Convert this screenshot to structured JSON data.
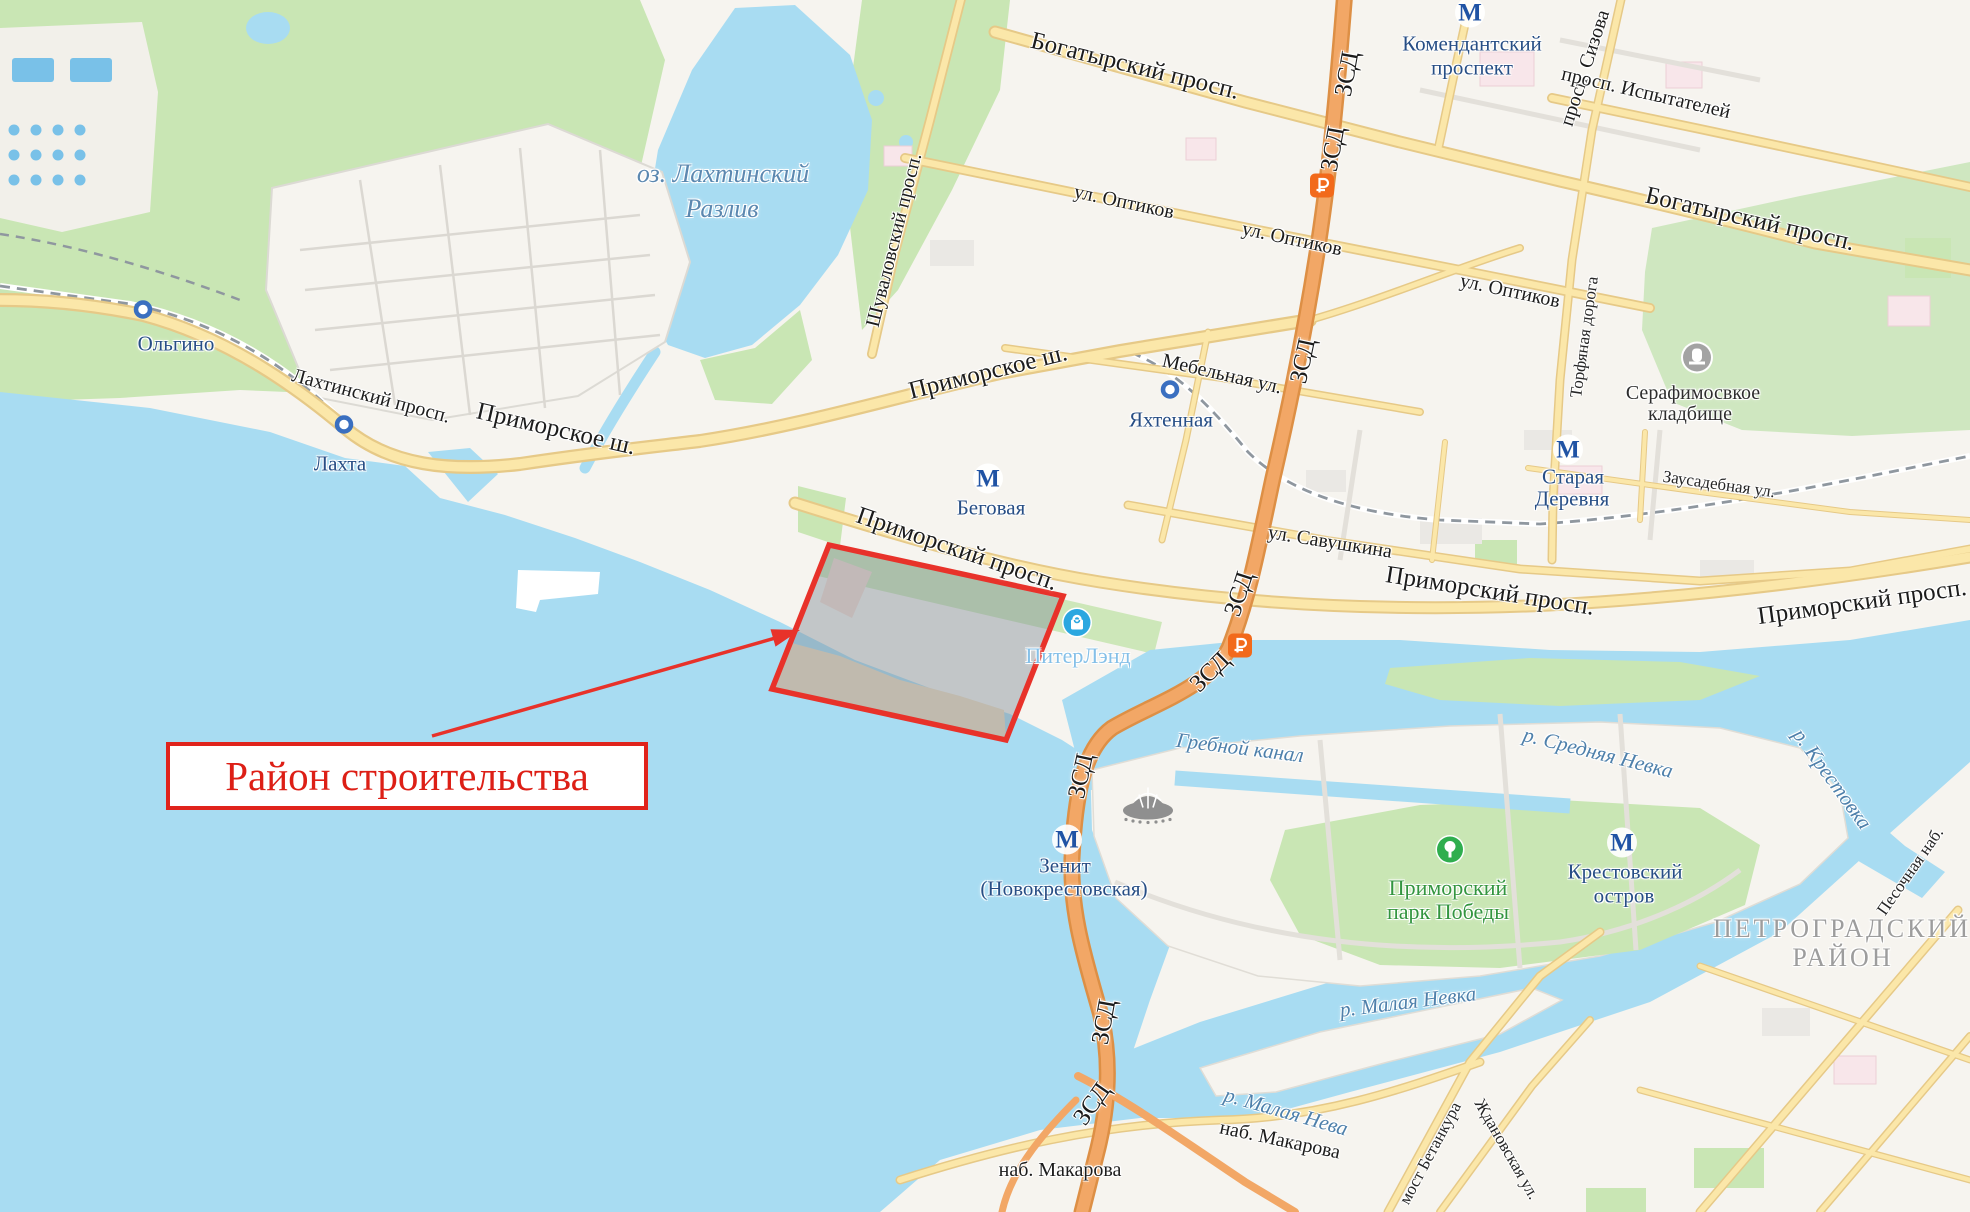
{
  "map": {
    "annotation": {
      "label": "Район строительства"
    },
    "colors": {
      "water": "#a8dcf2",
      "land": "#f6f4ef",
      "park": "#c9e6b4",
      "road_fill": "#fbe7a9",
      "road_casing": "#e6c987",
      "highway_fill": "#f2a766",
      "highway_casing": "#dd8f45",
      "railway": "#8f979f",
      "accent_red": "#e0231c",
      "metro_blue": "#2053a4",
      "station_text": "#274e85",
      "water_text": "#4e80ab",
      "district_gray": "#9d9d9d",
      "park_green": "#33953f",
      "mall_blue": "#2ba7e0",
      "toll_orange": "#f26a1b"
    },
    "labels": [
      {
        "id": "bogatyrsky-prosp-1",
        "text": "Богатырский просп.",
        "x": 1135,
        "y": 66,
        "rot": 14,
        "cls": "road-lg"
      },
      {
        "id": "bogatyrsky-prosp-2",
        "text": "Богатырский просп.",
        "x": 1750,
        "y": 219,
        "rot": 13,
        "cls": "road-lg"
      },
      {
        "id": "komendantsky-line1",
        "text": "Комендантский",
        "x": 1472,
        "y": 44,
        "rot": 0,
        "cls": "metro"
      },
      {
        "id": "komendantsky-line2",
        "text": "проспект",
        "x": 1472,
        "y": 68,
        "rot": 0,
        "cls": "metro"
      },
      {
        "id": "prosp-sizova",
        "text": "просп. Сизова",
        "x": 1585,
        "y": 68,
        "rot": -72,
        "cls": "road"
      },
      {
        "id": "prosp-ispytateley",
        "text": "просп. Испытателей",
        "x": 1646,
        "y": 93,
        "rot": 13,
        "cls": "road"
      },
      {
        "id": "zsd-1",
        "text": "ЗСД",
        "x": 1347,
        "y": 74,
        "rot": -80,
        "cls": "road-lg"
      },
      {
        "id": "zsd-2",
        "text": "ЗСД",
        "x": 1333,
        "y": 149,
        "rot": -80,
        "cls": "road-lg"
      },
      {
        "id": "ul-optikov-1",
        "text": "ул. Оптиков",
        "x": 1124,
        "y": 202,
        "rot": 12,
        "cls": "road"
      },
      {
        "id": "ul-optikov-2",
        "text": "ул. Оптиков",
        "x": 1292,
        "y": 239,
        "rot": 12,
        "cls": "road"
      },
      {
        "id": "ul-optikov-3",
        "text": "ул. Оптиков",
        "x": 1510,
        "y": 291,
        "rot": 12,
        "cls": "road"
      },
      {
        "id": "mebelnaya",
        "text": "Мебельная ул.",
        "x": 1222,
        "y": 374,
        "rot": 13,
        "cls": "road"
      },
      {
        "id": "shuvalovsky",
        "text": "Шуваловский просп.",
        "x": 894,
        "y": 240,
        "rot": -76,
        "cls": "road"
      },
      {
        "id": "primorskoe-sh-1",
        "text": "Приморское ш.",
        "x": 556,
        "y": 429,
        "rot": 13,
        "cls": "road-lg"
      },
      {
        "id": "primorskoe-sh-2",
        "text": "Приморское ш.",
        "x": 988,
        "y": 372,
        "rot": -14,
        "cls": "road-lg"
      },
      {
        "id": "lakhtinsky-prosp",
        "text": "Лахтинский просп.",
        "x": 371,
        "y": 396,
        "rot": 15,
        "cls": "road"
      },
      {
        "id": "olgino",
        "text": "Ольгино",
        "x": 176,
        "y": 344,
        "rot": 0,
        "cls": "station"
      },
      {
        "id": "lakhta",
        "text": "Лахта",
        "x": 340,
        "y": 464,
        "rot": 0,
        "cls": "station"
      },
      {
        "id": "lake-line1",
        "text": "оз. Лахтинский",
        "x": 723,
        "y": 174,
        "rot": 0,
        "cls": "water-lg"
      },
      {
        "id": "lake-line2",
        "text": "Разлив",
        "x": 722,
        "y": 209,
        "rot": 0,
        "cls": "water-lg"
      },
      {
        "id": "yakhtennaya",
        "text": "Яхтенная",
        "x": 1171,
        "y": 420,
        "rot": 0,
        "cls": "station"
      },
      {
        "id": "zsd-3",
        "text": "ЗСД",
        "x": 1303,
        "y": 361,
        "rot": -78,
        "cls": "road-lg"
      },
      {
        "id": "zsd-4",
        "text": "ЗСД",
        "x": 1239,
        "y": 594,
        "rot": -72,
        "cls": "road-lg"
      },
      {
        "id": "zsd-5",
        "text": "ЗСД",
        "x": 1210,
        "y": 672,
        "rot": -45,
        "cls": "road-lg"
      },
      {
        "id": "ul-savushkina",
        "text": "ул. Савушкина",
        "x": 1330,
        "y": 542,
        "rot": 9,
        "cls": "road"
      },
      {
        "id": "primorsky-prosp-1",
        "text": "Приморский просп.",
        "x": 957,
        "y": 549,
        "rot": 19,
        "cls": "road-lg"
      },
      {
        "id": "primorsky-prosp-2",
        "text": "Приморский просп.",
        "x": 1490,
        "y": 591,
        "rot": 9,
        "cls": "road-lg"
      },
      {
        "id": "primorsky-prosp-3",
        "text": "Приморский просп.",
        "x": 1862,
        "y": 602,
        "rot": -8,
        "cls": "road-lg"
      },
      {
        "id": "zausadebnaya",
        "text": "Заусадебная ул.",
        "x": 1719,
        "y": 484,
        "rot": 8,
        "cls": "road-sm"
      },
      {
        "id": "torfyanaya",
        "text": "Торфяная дорога",
        "x": 1584,
        "y": 337,
        "rot": -82,
        "cls": "road-sm"
      },
      {
        "id": "staraya-derevnya-1",
        "text": "Старая",
        "x": 1573,
        "y": 477,
        "rot": 0,
        "cls": "metro"
      },
      {
        "id": "staraya-derevnya-2",
        "text": "Деревня",
        "x": 1572,
        "y": 499,
        "rot": 0,
        "cls": "metro"
      },
      {
        "id": "serafimovskoe-1",
        "text": "Серафимосвкое",
        "x": 1693,
        "y": 393,
        "rot": 0,
        "cls": "poi"
      },
      {
        "id": "serafimovskoe-2",
        "text": "кладбище",
        "x": 1690,
        "y": 414,
        "rot": 0,
        "cls": "poi"
      },
      {
        "id": "begovaya",
        "text": "Беговая",
        "x": 991,
        "y": 508,
        "rot": 0,
        "cls": "metro"
      },
      {
        "id": "piterland",
        "text": "ПитерЛэнд",
        "x": 1078,
        "y": 656,
        "rot": 0,
        "cls": "mall"
      },
      {
        "id": "grebnoy-kanal",
        "text": "Гребной канал",
        "x": 1240,
        "y": 748,
        "rot": 7,
        "cls": "water"
      },
      {
        "id": "srednyaya-nevka",
        "text": "р. Средняя Невка",
        "x": 1598,
        "y": 753,
        "rot": 14,
        "cls": "water"
      },
      {
        "id": "krestovka",
        "text": "р. Крестовка",
        "x": 1832,
        "y": 779,
        "rot": 54,
        "cls": "water"
      },
      {
        "id": "zenit-line1",
        "text": "Зенит",
        "x": 1065,
        "y": 866,
        "rot": 0,
        "cls": "metro"
      },
      {
        "id": "zenit-line2",
        "text": "(Новокрестовская)",
        "x": 1064,
        "y": 889,
        "rot": 0,
        "cls": "metro"
      },
      {
        "id": "park-pobedy-1",
        "text": "Приморский",
        "x": 1448,
        "y": 888,
        "rot": 0,
        "cls": "park"
      },
      {
        "id": "park-pobedy-2",
        "text": "парк Победы",
        "x": 1448,
        "y": 912,
        "rot": 0,
        "cls": "park"
      },
      {
        "id": "krestovsky-1",
        "text": "Крестовский",
        "x": 1625,
        "y": 872,
        "rot": 0,
        "cls": "metro"
      },
      {
        "id": "krestovsky-2",
        "text": "остров",
        "x": 1624,
        "y": 896,
        "rot": 0,
        "cls": "metro"
      },
      {
        "id": "petrogradsky-1",
        "text": "ПЕТРОГРАДСКИЙ",
        "x": 1842,
        "y": 929,
        "rot": 0,
        "cls": "district"
      },
      {
        "id": "petrogradsky-2",
        "text": "РАЙОН",
        "x": 1843,
        "y": 958,
        "rot": 0,
        "cls": "district"
      },
      {
        "id": "pesochnaya-nab",
        "text": "Песочная наб.",
        "x": 1910,
        "y": 871,
        "rot": -55,
        "cls": "road-sm"
      },
      {
        "id": "zsd-6",
        "text": "ЗСД",
        "x": 1081,
        "y": 776,
        "rot": -78,
        "cls": "road-lg"
      },
      {
        "id": "zsd-7",
        "text": "ЗСД",
        "x": 1104,
        "y": 1022,
        "rot": -80,
        "cls": "road-lg"
      },
      {
        "id": "zsd-8",
        "text": "ЗСД",
        "x": 1092,
        "y": 1104,
        "rot": -55,
        "cls": "road-lg"
      },
      {
        "id": "malaya-nevka",
        "text": "р. Малая Невка",
        "x": 1408,
        "y": 1002,
        "rot": -7,
        "cls": "water"
      },
      {
        "id": "malaya-neva",
        "text": "р. Малая Нева",
        "x": 1286,
        "y": 1112,
        "rot": 16,
        "cls": "water"
      },
      {
        "id": "nab-makarova-1",
        "text": "наб. Макарова",
        "x": 1060,
        "y": 1170,
        "rot": 0,
        "cls": "road"
      },
      {
        "id": "nab-makarova-2",
        "text": "наб. Макарова",
        "x": 1280,
        "y": 1140,
        "rot": 12,
        "cls": "road"
      },
      {
        "id": "most-betankura",
        "text": "мост Бетанкура",
        "x": 1430,
        "y": 1153,
        "rot": -62,
        "cls": "road-sm"
      },
      {
        "id": "zhdanovskaya",
        "text": "Ждановская ул.",
        "x": 1507,
        "y": 1149,
        "rot": 60,
        "cls": "road-sm"
      }
    ],
    "icons": [
      {
        "id": "metro-komendantsky",
        "kind": "metro",
        "x": 1470,
        "y": 15
      },
      {
        "id": "metro-begovaya",
        "kind": "metro",
        "x": 988,
        "y": 481
      },
      {
        "id": "metro-staraya-derevnya",
        "kind": "metro",
        "x": 1568,
        "y": 452
      },
      {
        "id": "metro-zenit",
        "kind": "metro",
        "x": 1067,
        "y": 842
      },
      {
        "id": "metro-krestovsky",
        "kind": "metro",
        "x": 1622,
        "y": 845
      },
      {
        "id": "rail-olgino",
        "kind": "rail",
        "x": 143,
        "y": 312
      },
      {
        "id": "rail-lakhta",
        "kind": "rail",
        "x": 344,
        "y": 427
      },
      {
        "id": "rail-yakhtennaya",
        "kind": "rail",
        "x": 1170,
        "y": 392
      },
      {
        "id": "toll-1",
        "kind": "toll",
        "x": 1322,
        "y": 188
      },
      {
        "id": "toll-2",
        "kind": "toll",
        "x": 1240,
        "y": 648
      },
      {
        "id": "cemetery",
        "kind": "cemetery",
        "x": 1697,
        "y": 360
      },
      {
        "id": "mall-piterland",
        "kind": "mall",
        "x": 1077,
        "y": 625
      },
      {
        "id": "park-tree",
        "kind": "tree",
        "x": 1450,
        "y": 852
      },
      {
        "id": "stadium",
        "kind": "stadium",
        "x": 1148,
        "y": 805
      }
    ]
  }
}
